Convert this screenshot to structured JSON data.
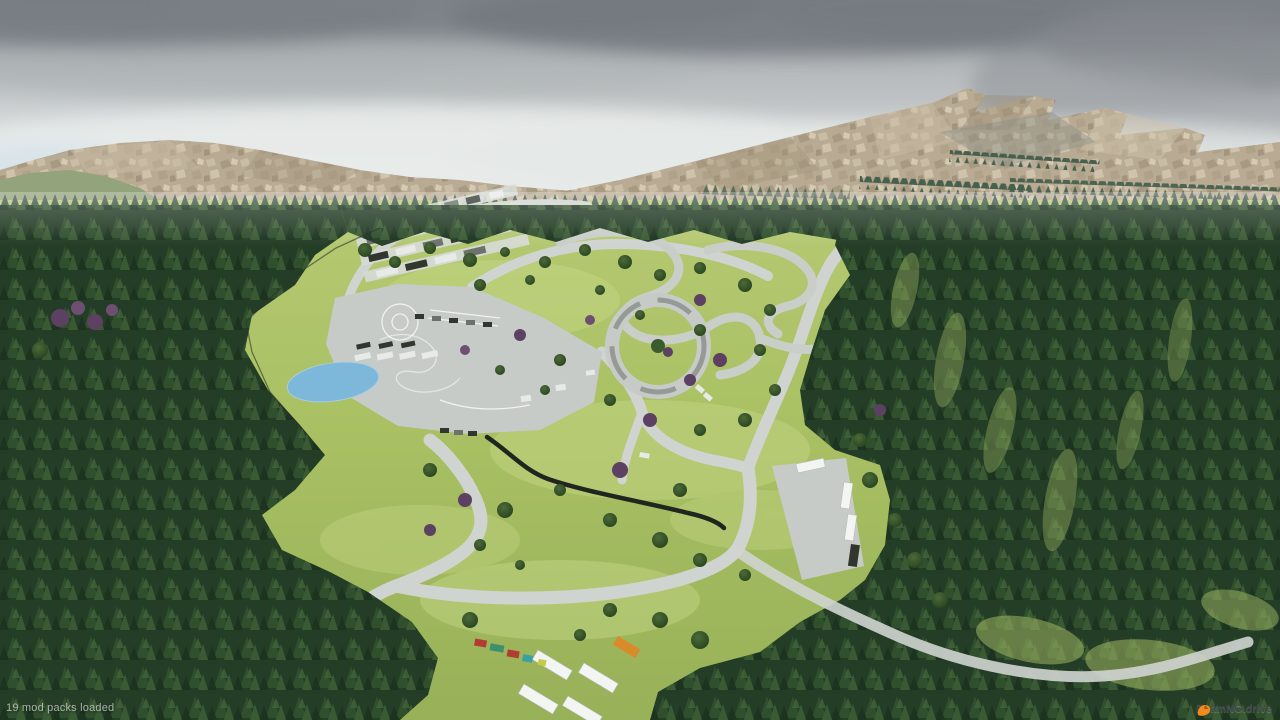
{
  "hud": {
    "status_message": "19 mod packs loaded",
    "watermark_text": "BeamNG.drive",
    "watermark_icon": "beamng-logo-icon"
  },
  "colors": {
    "sky_top": "#85898f",
    "sky_horizon": "#eef0ef",
    "cloud_dark": "#767b81",
    "mountain_rock": "#b9ab93",
    "distant_hill_green": "#93a37b",
    "forest_dark": "#243d26",
    "forest_highlight": "#3a5a33",
    "grass": "#aec469",
    "grass_light": "#c3d584",
    "road": "#d0d4d0",
    "asphalt_pad": "#c6cbc8",
    "pond_water": "#7db7d9",
    "truck_white": "#f3f5f3",
    "tree_purple": "#5d4163",
    "barrier_dark": "#20261f",
    "logo_orange": "#ef8a1d"
  }
}
